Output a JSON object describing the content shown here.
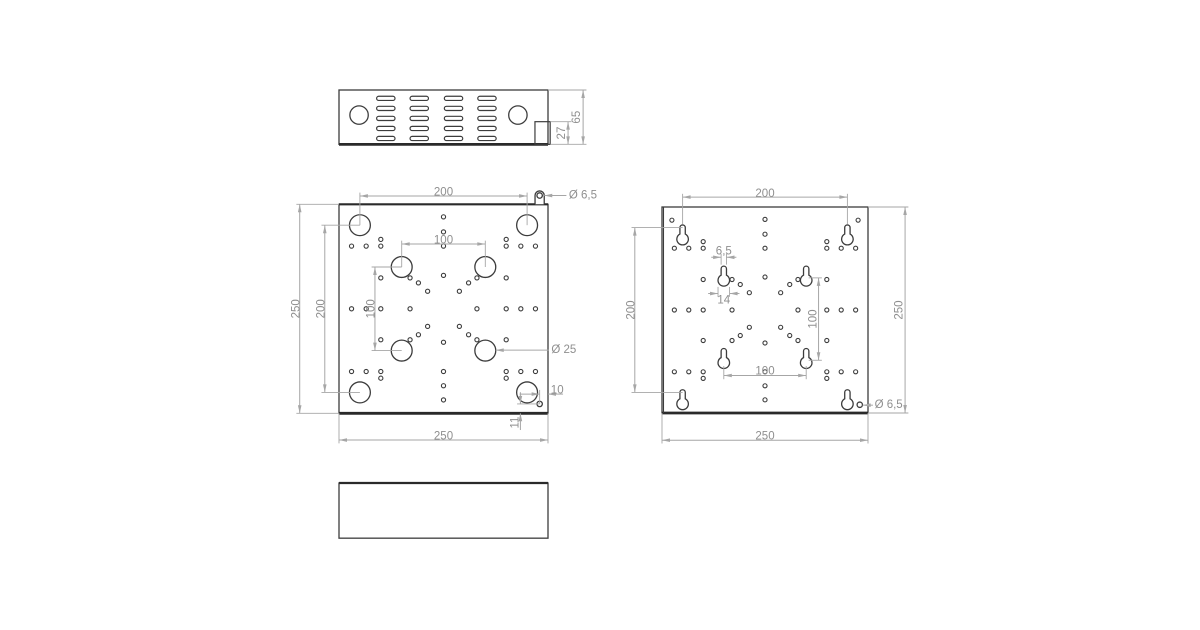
{
  "page": {
    "background": "#ffffff",
    "kind": "technical-drawing",
    "views_count": 4
  },
  "style": {
    "line": "#3c3c3c",
    "line_thick": "#2a2a2a",
    "dim_line": "#a6a6a6",
    "dim_text": "#8f8f8f",
    "font_size": 11.5,
    "small_hole_d": 5
  },
  "patterns": {
    "small_holes": [
      [
        15,
        50
      ],
      [
        32.5,
        50
      ],
      [
        50,
        50
      ],
      [
        50,
        42
      ],
      [
        235,
        50
      ],
      [
        217.5,
        50
      ],
      [
        200,
        50
      ],
      [
        200,
        42
      ],
      [
        15,
        200
      ],
      [
        32.5,
        200
      ],
      [
        50,
        200
      ],
      [
        50,
        208
      ],
      [
        235,
        200
      ],
      [
        217.5,
        200
      ],
      [
        200,
        200
      ],
      [
        200,
        208
      ],
      [
        125,
        15
      ],
      [
        125,
        33
      ],
      [
        125,
        50
      ],
      [
        125,
        85
      ],
      [
        125,
        165
      ],
      [
        125,
        200
      ],
      [
        125,
        217
      ],
      [
        125,
        234
      ],
      [
        15,
        125
      ],
      [
        32.5,
        125
      ],
      [
        50,
        125
      ],
      [
        85,
        125
      ],
      [
        165,
        125
      ],
      [
        200,
        125
      ],
      [
        217.5,
        125
      ],
      [
        235,
        125
      ],
      [
        50,
        88
      ],
      [
        85,
        88
      ],
      [
        165,
        88
      ],
      [
        200,
        88
      ],
      [
        50,
        162
      ],
      [
        85,
        162
      ],
      [
        165,
        162
      ],
      [
        200,
        162
      ],
      [
        95,
        94
      ],
      [
        106,
        104
      ],
      [
        155,
        94
      ],
      [
        144,
        104
      ],
      [
        95,
        156
      ],
      [
        106,
        146
      ],
      [
        155,
        156
      ],
      [
        144,
        146
      ]
    ]
  },
  "views": [
    {
      "id": "top-view",
      "origin": [
        339,
        90
      ],
      "scale": 0.836,
      "plate": {
        "w": 250,
        "h": 65,
        "thick_edges": [
          "bottom"
        ]
      },
      "circles": [
        {
          "d": 22,
          "centers": [
            [
              24,
              30
            ],
            [
              214,
              30
            ]
          ]
        }
      ],
      "vents": {
        "cols": [
          56,
          96,
          137,
          177
        ],
        "rows": [
          10,
          22,
          34,
          46,
          58
        ],
        "w": 22,
        "h": 5
      },
      "rects": [
        {
          "x": 234.4,
          "y": 37.9,
          "w": 18.2,
          "h": 27.1
        }
      ],
      "dims": [
        {
          "type": "v",
          "label": "65",
          "x": 292,
          "y1": 0,
          "y2": 65,
          "text": [
            284.5,
            32.5
          ],
          "ext": [
            [
              250,
              0,
              296,
              0
            ],
            [
              252.6,
              65,
              296,
              65
            ]
          ]
        },
        {
          "type": "v",
          "label": "27",
          "x": 274,
          "y1": 37.9,
          "y2": 65,
          "text": [
            266.5,
            51.5
          ],
          "ext": [
            [
              252.6,
              37.9,
              278,
              37.9
            ]
          ]
        }
      ]
    },
    {
      "id": "front-plate-view",
      "origin": [
        339,
        204.3
      ],
      "scale": 0.836,
      "plate": {
        "w": 250,
        "h": 250,
        "thick_edges": [
          "bottom",
          "top"
        ]
      },
      "circles": [
        {
          "d": 25,
          "centers": [
            [
              25,
              25
            ],
            [
              225,
              25
            ],
            [
              25,
              225
            ],
            [
              225,
              225
            ],
            [
              75,
              75
            ],
            [
              175,
              75
            ],
            [
              75,
              175
            ],
            [
              175,
              175
            ]
          ]
        },
        {
          "d": 6.5,
          "centers": [
            [
              240,
              238.8
            ]
          ]
        }
      ],
      "eyelet": {
        "center": [
          240,
          -10.5
        ],
        "outer_d": 11,
        "hole_d": 6.5
      },
      "small_holes": {
        "pattern": "small_holes"
      },
      "dims": [
        {
          "type": "h",
          "label": "200",
          "y": -10,
          "x1": 25,
          "x2": 225,
          "text": [
            125,
            -14
          ],
          "ext": [
            [
              25,
              25,
              25,
              -14
            ],
            [
              225,
              25,
              225,
              -14
            ]
          ]
        },
        {
          "type": "h",
          "label": "100",
          "y": 47.5,
          "x1": 75,
          "x2": 175,
          "text": [
            125,
            43.5
          ],
          "ext": [
            [
              75,
              75,
              75,
              43.5
            ],
            [
              175,
              75,
              175,
              43.5
            ]
          ]
        },
        {
          "type": "v",
          "label": "250",
          "x": -47,
          "y1": 0,
          "y2": 250,
          "text": [
            -51,
            125
          ],
          "ext": [
            [
              0,
              0,
              -51,
              0
            ],
            [
              0,
              250,
              -51,
              250
            ]
          ]
        },
        {
          "type": "v",
          "label": "200",
          "x": -17,
          "y1": 25,
          "y2": 225,
          "text": [
            -21,
            125
          ],
          "ext": [
            [
              25,
              25,
              -21,
              25
            ],
            [
              25,
              225,
              -21,
              225
            ]
          ]
        },
        {
          "type": "v",
          "label": "100",
          "x": 43,
          "y1": 75,
          "y2": 175,
          "text": [
            39,
            125
          ],
          "ext": [
            [
              75,
              75,
              39,
              75
            ],
            [
              75,
              175,
              39,
              175
            ]
          ]
        },
        {
          "type": "h",
          "label": "250",
          "y": 282,
          "x1": 0,
          "x2": 250,
          "text": [
            125,
            277.5
          ],
          "ext": [
            [
              0,
              250,
              0,
              286
            ],
            [
              250,
              250,
              250,
              286
            ]
          ]
        },
        {
          "type": "leader",
          "label": "Ø 25",
          "tip": [
            187.5,
            174.5
          ],
          "to_x": 251,
          "text": [
            254,
            174.5
          ]
        },
        {
          "type": "leader",
          "label": "Ø 6,5",
          "tip": [
            245.5,
            -10.5
          ],
          "to_x": 272,
          "text": [
            275,
            -10.5
          ]
        },
        {
          "type": "h",
          "label": "10",
          "y": 227,
          "x1": 240,
          "x2": 250,
          "outside": true,
          "tail1": 24,
          "tail2": 18,
          "text": [
            261,
            222.5
          ],
          "ext": [
            [
              240,
              238.8,
              240,
              222
            ]
          ]
        },
        {
          "type": "v",
          "label": "11",
          "x": 217,
          "y1": 238.8,
          "y2": 250,
          "outside": true,
          "tail1": 14,
          "tail2": 20,
          "text": [
            211,
            261
          ],
          "ext": [
            [
              240,
              238.8,
              213,
              238.8
            ]
          ]
        }
      ]
    },
    {
      "id": "back-plate-view",
      "origin": [
        662,
        207
      ],
      "scale": 0.824,
      "plate": {
        "w": 250,
        "h": 250,
        "thick_edges": [
          "bottom"
        ],
        "double_left": true
      },
      "keyholes": {
        "slot_w": 6.5,
        "bulb_d": 14,
        "bulb_offset": 14,
        "refs": [
          [
            25,
            25
          ],
          [
            225,
            25
          ],
          [
            25,
            225
          ],
          [
            225,
            225
          ],
          [
            75,
            75
          ],
          [
            175,
            75
          ],
          [
            75,
            175
          ],
          [
            175,
            175
          ]
        ]
      },
      "circles": [
        {
          "d": 6.5,
          "centers": [
            [
              240,
              240
            ]
          ]
        }
      ],
      "small_holes": {
        "pattern": "small_holes",
        "extra": [
          [
            12,
            16
          ],
          [
            238,
            16
          ]
        ]
      },
      "dims": [
        {
          "type": "h",
          "label": "200",
          "y": -12,
          "x1": 25,
          "x2": 225,
          "text": [
            125,
            -16
          ],
          "ext": [
            [
              25,
              21,
              25,
              -16
            ],
            [
              225,
              21,
              225,
              -16
            ]
          ]
        },
        {
          "type": "v",
          "label": "200",
          "x": -33,
          "y1": 25,
          "y2": 225,
          "text": [
            -37,
            125
          ],
          "ext": [
            [
              25,
              25,
              -37,
              25
            ],
            [
              25,
              225,
              -37,
              225
            ]
          ]
        },
        {
          "type": "v",
          "label": "250",
          "x": 295,
          "y1": 0,
          "y2": 250,
          "text": [
            288,
            125
          ],
          "ext": [
            [
              250,
              0,
              299,
              0
            ],
            [
              250,
              250,
              299,
              250
            ]
          ]
        },
        {
          "type": "h",
          "label": "250",
          "y": 283,
          "x1": 0,
          "x2": 250,
          "text": [
            125,
            278.5
          ],
          "ext": [
            [
              0,
              250,
              0,
              287
            ],
            [
              250,
              250,
              250,
              287
            ]
          ]
        },
        {
          "type": "h",
          "label": "6,5",
          "y": 61,
          "x1": 71.75,
          "x2": 78.25,
          "outside": true,
          "tail1": 12,
          "tail2": 12,
          "text": [
            75,
            54
          ],
          "ext": [
            [
              71.75,
              70,
              71.75,
              57
            ],
            [
              78.25,
              70,
              78.25,
              57
            ]
          ]
        },
        {
          "type": "h",
          "label": "14",
          "y": 105,
          "x1": 68,
          "x2": 82,
          "outside": true,
          "tail1": 12,
          "tail2": 12,
          "text": [
            75,
            113.5
          ],
          "ext": [
            [
              68,
              97,
              68,
              109
            ],
            [
              82,
              97,
              82,
              109
            ]
          ]
        },
        {
          "type": "h",
          "label": "100",
          "y": 204.5,
          "x1": 75,
          "x2": 175,
          "text": [
            125,
            199.5
          ],
          "ext": [
            [
              75,
              193,
              75,
              209
            ],
            [
              175,
              193,
              175,
              209
            ]
          ]
        },
        {
          "type": "v",
          "label": "100",
          "x": 190,
          "y1": 86,
          "y2": 186,
          "text": [
            184,
            136
          ],
          "ext": [
            [
              178,
              86,
              194,
              86
            ],
            [
              178,
              186,
              194,
              186
            ]
          ]
        },
        {
          "type": "leader",
          "label": "Ø 6,5",
          "tip": [
            243.5,
            240.5
          ],
          "to_x": 256,
          "text": [
            258,
            240.5
          ]
        }
      ]
    },
    {
      "id": "bottom-view",
      "origin": [
        339,
        483
      ],
      "scale": 0.836,
      "plate": {
        "w": 250,
        "h": 66,
        "thick_edges": [
          "top"
        ]
      },
      "dims": []
    }
  ]
}
